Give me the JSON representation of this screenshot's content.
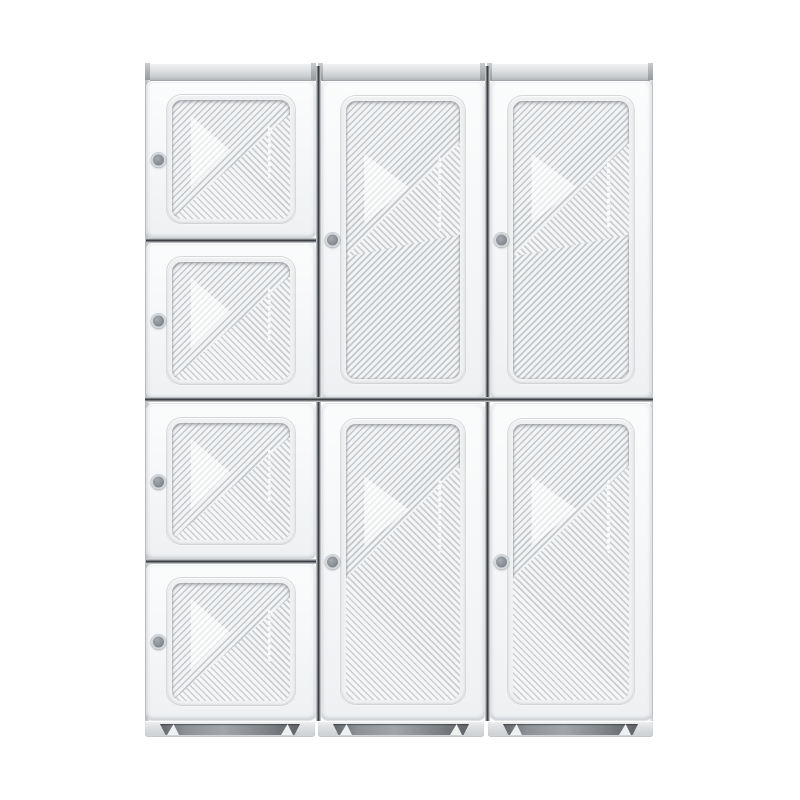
{
  "image": {
    "description": "Front-view product photo of a white modular plastic wardrobe cabinet with ribbed door panels on a plain white background",
    "background": "#ffffff"
  },
  "cabinet": {
    "total_doors": 8,
    "knobs_per_door": 1,
    "columns": [
      {
        "id": "left",
        "door_count": 4,
        "door_type": "small square door"
      },
      {
        "id": "middle",
        "door_count": 2,
        "door_type": "tall door"
      },
      {
        "id": "right",
        "door_count": 2,
        "door_type": "tall door"
      }
    ],
    "features": [
      "diagonal ribbed texture",
      "glossy triangle reflection",
      "vertical highlight streak",
      "top trim strip",
      "plinth with corner feet"
    ],
    "colors": {
      "door_face": "#f5f6f8",
      "stripe_dark": "#c5c8cb",
      "stripe_light": "#f3f4f5",
      "sheen_dark": "#cbced1",
      "sheen_light": "#f5f6f7",
      "tri_dark": "#e9ebed",
      "tri_light": "#fcfdfd",
      "panel_frame": "#eef0f1",
      "knob_ring": "#d4d7da",
      "knob_face_outer": "#75797f",
      "knob_face_inner": "#a6abb0",
      "groove_dark": "#3e4145",
      "band_top": "#f2f3f4",
      "band_bottom": "#b4b7ba",
      "base_face": "#dddfe1",
      "recess_dark": "#63666a",
      "recess_mid": "#a2a6aa",
      "side_strip": "#c2c5c8"
    }
  }
}
